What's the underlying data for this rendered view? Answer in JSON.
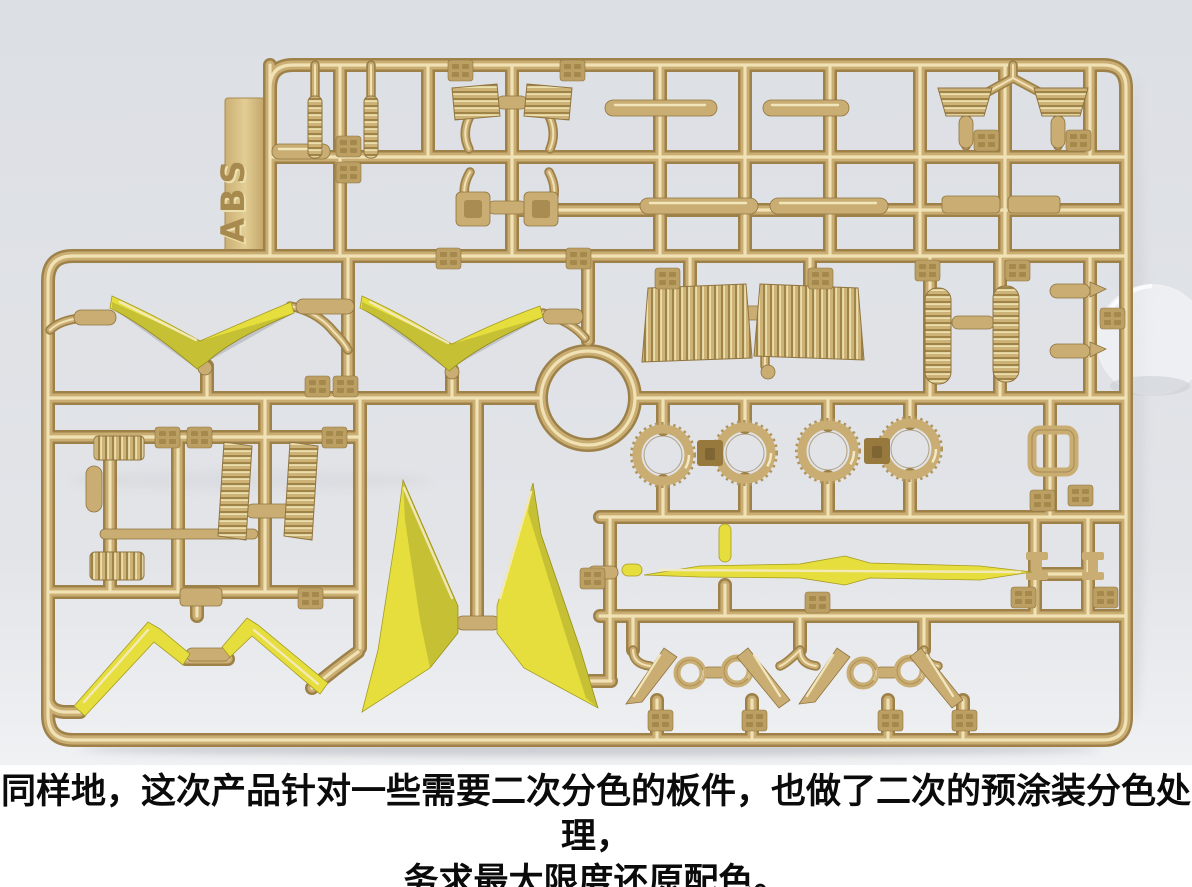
{
  "caption": {
    "line1": "同样地，这次产品针对一些需要二次分色的板件，也做了二次的预涂装分色处理，",
    "line2": "务求最大限度还原配色。"
  },
  "sprue": {
    "tab_label": "ABS",
    "description": "gold-plated model kit runner with pre-painted yellow parts"
  },
  "colors": {
    "background": "#dfe1e6",
    "gold_dark": "#9d8148",
    "gold_base": "#c9ad72",
    "gold_highlight": "#f0e2b4",
    "yellow": "#e5de3d",
    "caption_bg": "#ffffff",
    "caption_text": "#0b0b0b"
  }
}
